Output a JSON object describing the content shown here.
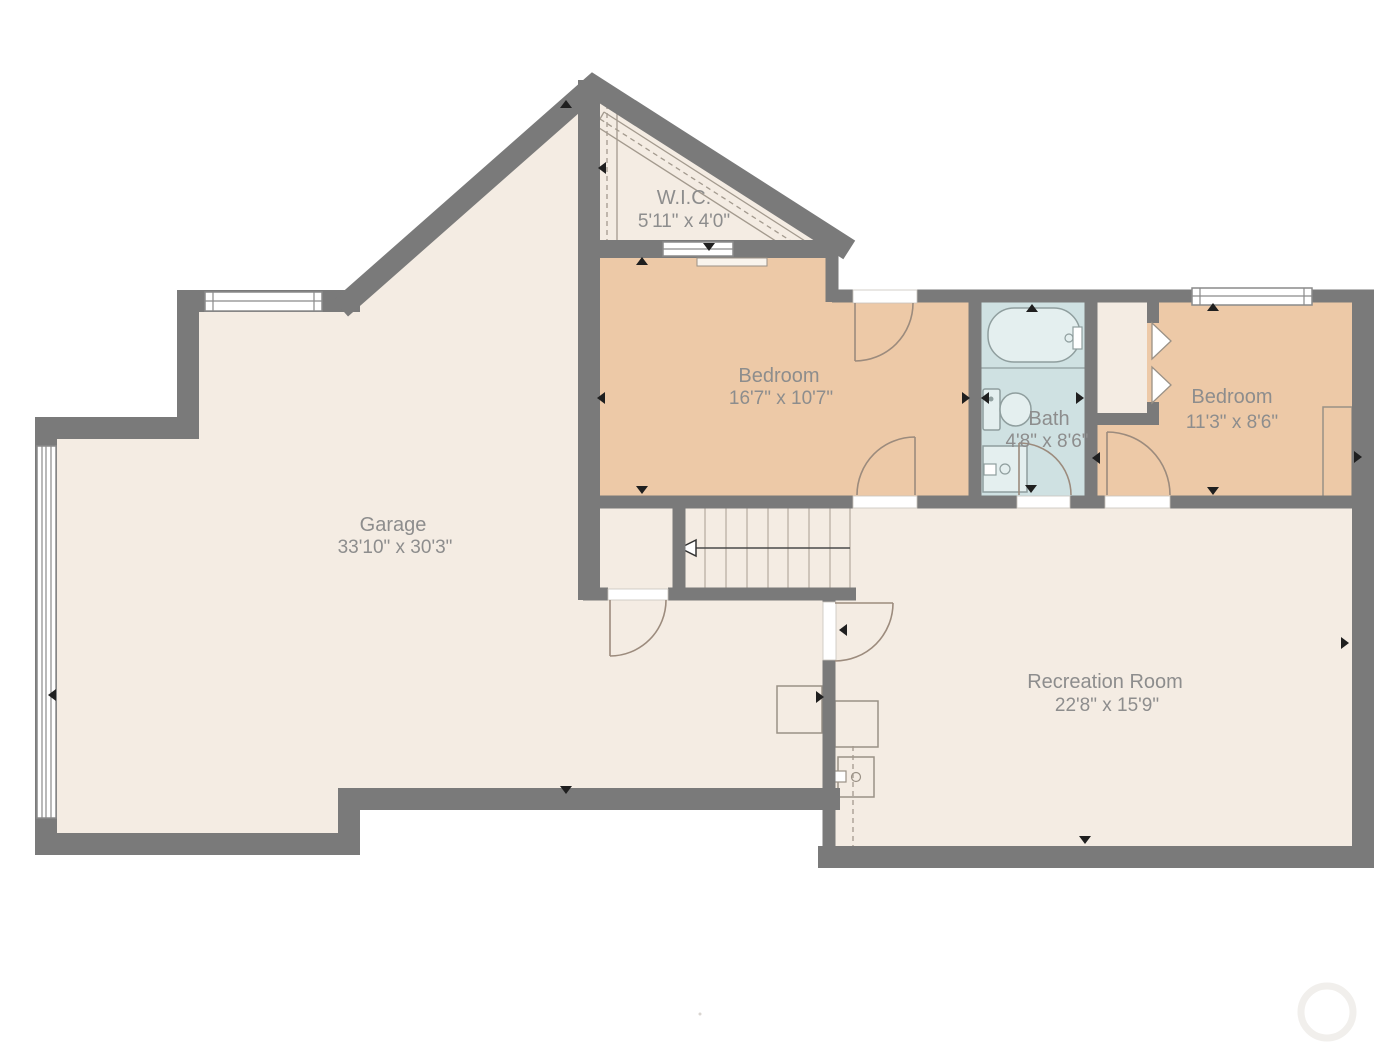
{
  "plan": {
    "rooms": {
      "wic": {
        "name": "W.I.C.",
        "dims": "5'11\" x 4'0\""
      },
      "bedroom1": {
        "name": "Bedroom",
        "dims": "16'7\" x 10'7\""
      },
      "bath": {
        "name": "Bath",
        "dims": "4'8\" x 8'6\""
      },
      "bedroom2": {
        "name": "Bedroom",
        "dims": "11'3\" x 8'6\""
      },
      "garage": {
        "name": "Garage",
        "dims": "33'10\" x 30'3\""
      },
      "recreation": {
        "name": "Recreation Room",
        "dims": "22'8\" x 15'9\""
      }
    },
    "colors": {
      "wall": "#7a7a7a",
      "floor": "#f4ece3",
      "bedroom": "#edc9a7",
      "bath": "#cfe1e2",
      "label": "#8d8d8d"
    }
  }
}
